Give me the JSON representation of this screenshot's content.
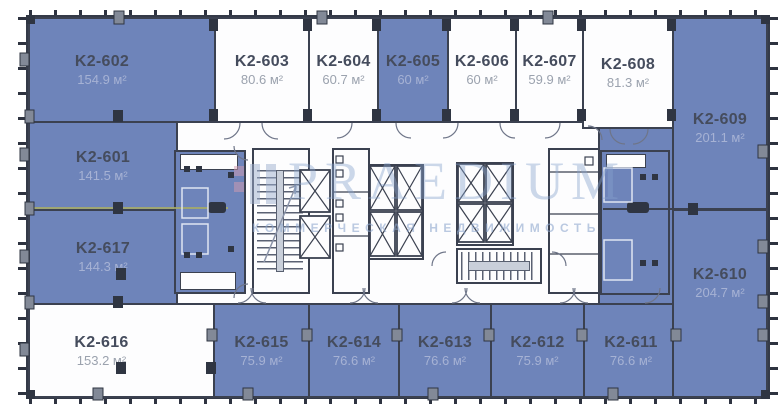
{
  "watermark": {
    "brand": "PRAEDIUM",
    "tagline": "КОММЕРЧЕСКАЯ НЕДВИЖИМОСТЬ"
  },
  "area_unit": "м²",
  "colors": {
    "highlight_fill": "#6e84ba",
    "wall": "#3b4150",
    "watermark": "#8aa2cc"
  },
  "rooms": [
    {
      "id": "K2-601",
      "area": "141.5 м²",
      "highlighted": true
    },
    {
      "id": "K2-602",
      "area": "154.9 м²",
      "highlighted": true
    },
    {
      "id": "K2-603",
      "area": "80.6 м²",
      "highlighted": false
    },
    {
      "id": "K2-604",
      "area": "60.7 м²",
      "highlighted": false
    },
    {
      "id": "K2-605",
      "area": "60 м²",
      "highlighted": true
    },
    {
      "id": "K2-606",
      "area": "60 м²",
      "highlighted": false
    },
    {
      "id": "K2-607",
      "area": "59.9 м²",
      "highlighted": false
    },
    {
      "id": "K2-608",
      "area": "81.3 м²",
      "highlighted": false
    },
    {
      "id": "K2-609",
      "area": "201.1 м²",
      "highlighted": true
    },
    {
      "id": "K2-610",
      "area": "204.7 м²",
      "highlighted": true
    },
    {
      "id": "K2-611",
      "area": "76.6 м²",
      "highlighted": true
    },
    {
      "id": "K2-612",
      "area": "75.9 м²",
      "highlighted": true
    },
    {
      "id": "K2-613",
      "area": "76.6 м²",
      "highlighted": true
    },
    {
      "id": "K2-614",
      "area": "76.6 м²",
      "highlighted": true
    },
    {
      "id": "K2-615",
      "area": "75.9 м²",
      "highlighted": true
    },
    {
      "id": "K2-616",
      "area": "153.2 м²",
      "highlighted": false
    },
    {
      "id": "K2-617",
      "area": "144.3 м²",
      "highlighted": true
    }
  ]
}
